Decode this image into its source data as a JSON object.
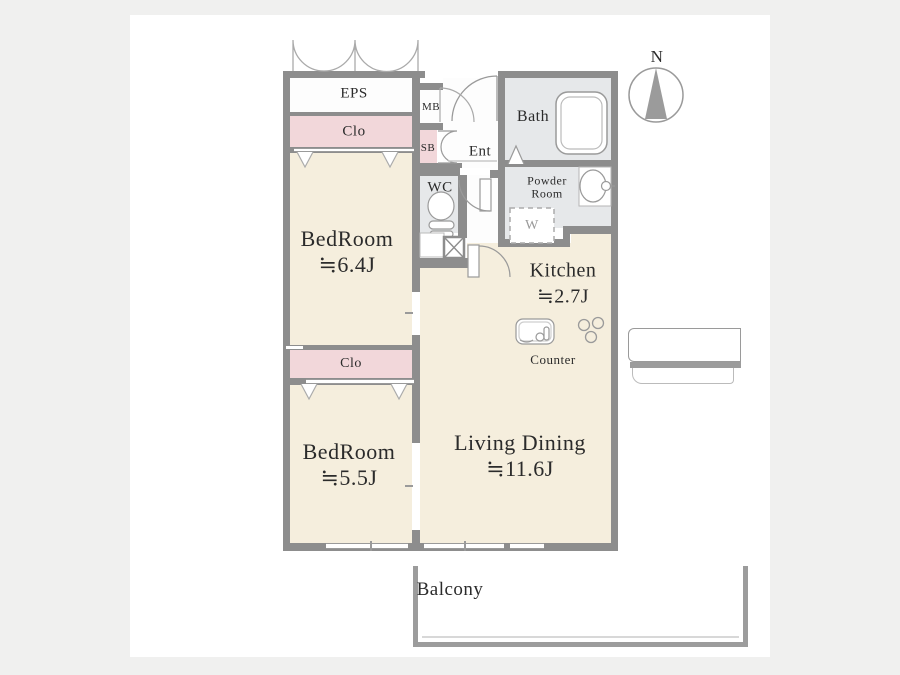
{
  "compass": {
    "north_label": "N"
  },
  "rooms": {
    "eps": {
      "label": "EPS"
    },
    "closet_upper": {
      "label": "Clo"
    },
    "bedroom_upper": {
      "name": "BedRoom",
      "size": "≒6.4J"
    },
    "closet_lower": {
      "label": "Clo"
    },
    "bedroom_lower": {
      "name": "BedRoom",
      "size": "≒5.5J"
    },
    "living_dining": {
      "name": "Living Dining",
      "size": "≒11.6J"
    },
    "kitchen": {
      "name": "Kitchen",
      "size": "≒2.7J"
    },
    "counter": {
      "label": "Counter"
    },
    "bath": {
      "label": "Bath"
    },
    "powder_room": {
      "line1": "Powder",
      "line2": "Room"
    },
    "washer": {
      "label": "W"
    },
    "wc": {
      "label": "WC"
    },
    "entrance": {
      "label": "Ent"
    },
    "meter_box": {
      "label": "MB"
    },
    "shoe_box": {
      "label": "SB"
    },
    "balcony": {
      "label": "Balcony"
    }
  },
  "colors": {
    "room_cream": "#f5eedd",
    "closet_pink": "#f2d7da",
    "wet_area_gray": "#e6e8ea",
    "wall_gray": "#8d8d8d",
    "page_background": "#f0f0ef"
  }
}
